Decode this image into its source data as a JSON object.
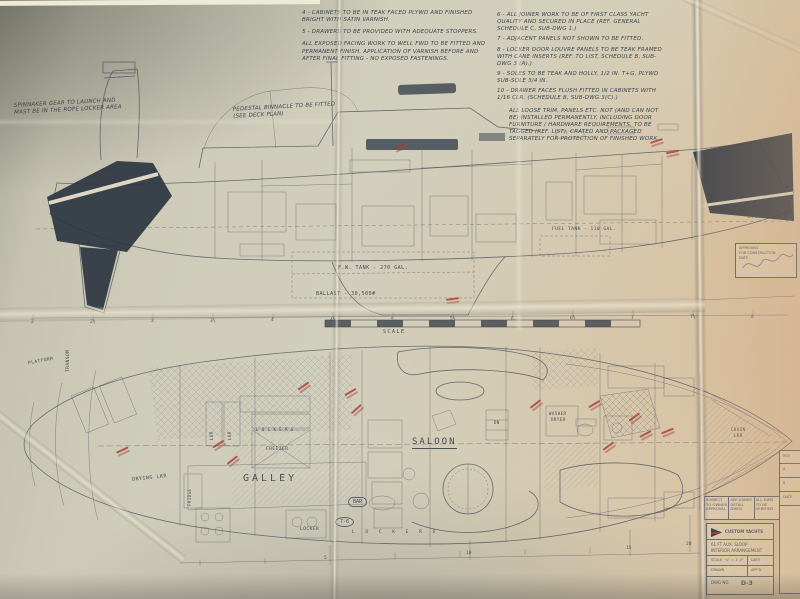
{
  "notes_left": {
    "items": [
      "4 - CABINETS TO BE IN TEAK FACED PLYWD AND FINISHED BRIGHT WITH SATIN VARNISH.",
      "5 - DRAWERS TO BE PROVIDED WITH ADEQUATE STOPPERS.",
      "ALL EXPOSED FACING WORK TO WELL FWD TO BE FITTED AND PERMANENT FINISH. APPLICATION OF VARNISH BEFORE AND AFTER FINAL FITTING - NO EXPOSED FASTENINGS."
    ]
  },
  "notes_right": {
    "items": [
      "6 - ALL JOINER WORK TO BE OF FIRST CLASS YACHT QUALITY AND SECURED IN PLACE (REF. GENERAL SCHEDULE C, SUB-DWG 1.)",
      "7 - ADJACENT PANELS NOT SHOWN TO BE FITTED.",
      "8 - LOCKER DOOR LOUVRE PANELS TO BE TEAK FRAMED WITH CANE INSERTS (REF. TO LIST, SCHEDULE B, SUB-DWG 3 (A).)",
      "9 - SOLES TO BE TEAK AND HOLLY, 1/2 IN. T+G, PLYWD SUB-SOLE 3/4 IN.",
      "10 - DRAWER FACES FLUSH FITTED IN CABINETS WITH 1/16 CLR. (SCHEDULE B, SUB-DWG 3(C).)"
    ],
    "footnote": "ALL LOOSE TRIM, PANELS ETC. NOT (AND CAN NOT BE) INSTALLED PERMANENTLY, INCLUDING DOOR FURNITURE / HARDWARE REQUIREMENTS, TO BE TAGGED (REF. LIST), CRATED AND PACKAGED SEPARATELY FOR PROTECTION OF FINISHED WORK."
  },
  "elevation": {
    "spinnaker_note": "SPINNAKER GEAR TO LAUNCH AND MAST BE IN THE ROPE LOCKER AREA",
    "binnacle_note": "PEDESTAL BINNACLE TO BE FITTED (SEE DECK PLAN)",
    "fw_tank_label": "F.W. TANK - 270 GAL.",
    "ballast_label": "BALLAST - 30,500#",
    "fuel_tank_label": "FUEL TANK - 110 GAL.",
    "lwl_label": "L.W.L.",
    "scale_label": "SCALE",
    "stations": [
      "2",
      "2½",
      "3",
      "3½",
      "4",
      "4½",
      "5",
      "5½",
      "6",
      "6½",
      "7",
      "7½",
      "8"
    ]
  },
  "plan": {
    "platform": "PLATFORM",
    "transom": "TRANSOM",
    "drying_locker": "DRYING LKR",
    "locker_abbrev_1": "LKR",
    "locker_abbrev_2": "LKR",
    "lockers_mid": "L O C K E R S",
    "freezer": "FREEZER",
    "galley": "GALLEY",
    "fridge": "FRIDGE",
    "locker_bottom": "LOCKER",
    "lockers_bottom": "L O C K E R S",
    "bar": "BAR",
    "dim_badge": "7-6",
    "saloon": "SALOON",
    "dn": "DN",
    "washer_line1": "WASHER",
    "washer_line2": "DRYER",
    "chain_line1": "CHAIN",
    "chain_line2": "LKR",
    "stations_bottom": [
      "5",
      "10",
      "15",
      "20"
    ]
  },
  "stamp": {
    "line1": "APPROVED",
    "line2": "FOR CONSTRUCTION",
    "line3": "DATE"
  },
  "legend": {
    "cells": [
      "SUBJECT TO OWNER APPROVAL",
      "SEE JOINER DETAIL DWGS",
      "ALL DIMS TO BE VERIFIED"
    ]
  },
  "title_block": {
    "brand": "CUSTOM YACHTS",
    "line1": "61 FT AUX. SLOOP",
    "line2": "INTERIOR ARRANGEMENT",
    "scale_key": "SCALE",
    "scale_val": "¾\" = 1'-0\"",
    "date_key": "DATE",
    "drawn_key": "DRAWN",
    "appd_key": "APP'D",
    "dwg_key": "DWG NO.",
    "dwg_val": "D-3"
  },
  "side_strip": {
    "rows": [
      "REV",
      "A",
      "B",
      "DATE"
    ]
  }
}
